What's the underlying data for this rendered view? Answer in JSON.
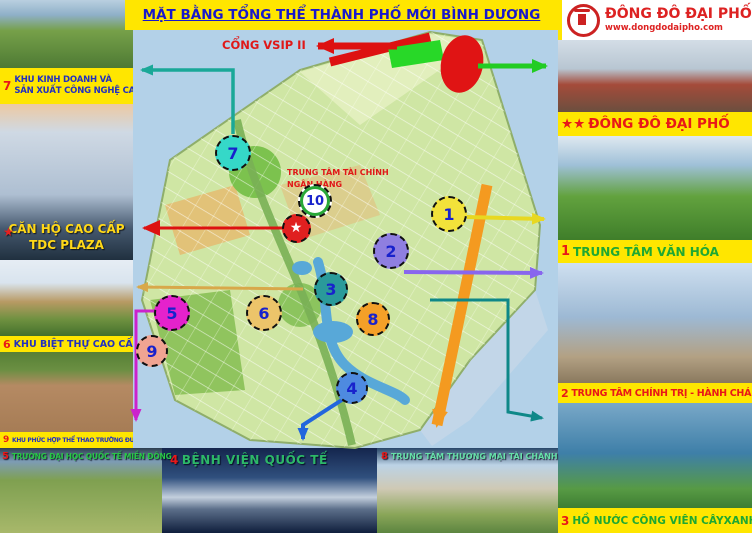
{
  "header": {
    "title": "MẶT BẰNG TỔNG THỂ THÀNH PHỐ MỚI BÌNH DƯƠNG"
  },
  "logo": {
    "name": "ĐÔNG ĐÔ ĐẠI PHỐ",
    "website": "www.dongdodaipho.com"
  },
  "colors": {
    "accent_yellow": "#ffe600",
    "accent_red": "#dd2222",
    "accent_blue": "#1818cc",
    "map_water": "#b3d1e8"
  },
  "left_column": {
    "label_7": {
      "num": "7",
      "line1": "KHU KINH DOANH VÀ",
      "line2": "SẢN XUẤT CÔNG NGHỆ CAO"
    },
    "tdc_overlay": {
      "star": "★",
      "line1": "CĂN HỘ CAO CẤP",
      "line2": "TDC PLAZA"
    },
    "label_6": {
      "num": "6",
      "text": "KHU BIỆT THỰ CAO CẤP"
    },
    "label_9": {
      "num": "9",
      "text": "KHU PHỨC HỢP THỂ THAO TRƯỜNG ĐUA NGỰA"
    }
  },
  "bottom_row": {
    "label_5": {
      "num": "5",
      "text": "TRƯỜNG ĐẠI HỌC QUỐC TẾ MIỀN ĐÔNG"
    },
    "label_4": {
      "num": "4",
      "text": "BỆNH VIỆN QUỐC TẾ"
    },
    "label_8": {
      "num": "8",
      "text": "TRUNG TÂM THƯƠNG MẠI TÀI CHÁNH"
    }
  },
  "right_column": {
    "label_brand": {
      "stars": "★★",
      "text": "ĐÔNG ĐÔ ĐẠI PHỐ"
    },
    "label_1": {
      "num": "1",
      "text": "TRUNG TÂM VĂN HÓA"
    },
    "label_2": {
      "num": "2",
      "text": "TRUNG TÂM CHÍNH TRỊ - HÀNH CHÁNH"
    },
    "label_3": {
      "num": "3",
      "text": "HỒ NƯỚC CÔNG VIÊN CÂYXANH"
    }
  },
  "map": {
    "gate_label": "CỔNG VSIP II",
    "finance_label_line1": "TRUNG TÂM TÀI CHÍNH",
    "finance_label_line2": "NGÂN HÀNG",
    "markers": [
      {
        "name": "7",
        "label": "7",
        "x": 233,
        "y": 153,
        "size": 36,
        "color": "#35d8c8"
      },
      {
        "name": "10",
        "label": "10",
        "x": 315,
        "y": 201,
        "size": 34,
        "color": "#ffffff",
        "ring": "#28a838",
        "font": 13
      },
      {
        "name": "star",
        "label": "★",
        "x": 296,
        "y": 228,
        "size": 29,
        "color": "#e02020",
        "text_color": "#ffffff",
        "font": 14
      },
      {
        "name": "1",
        "label": "1",
        "x": 449,
        "y": 214,
        "size": 36,
        "color": "#f2e23a"
      },
      {
        "name": "2",
        "label": "2",
        "x": 391,
        "y": 251,
        "size": 36,
        "color": "#8f7fe0"
      },
      {
        "name": "3",
        "label": "3",
        "x": 331,
        "y": 289,
        "size": 34,
        "color": "#2a9a9a"
      },
      {
        "name": "5",
        "label": "5",
        "x": 172,
        "y": 313,
        "size": 36,
        "color": "#e422cc"
      },
      {
        "name": "6",
        "label": "6",
        "x": 264,
        "y": 313,
        "size": 36,
        "color": "#ecc46a"
      },
      {
        "name": "8",
        "label": "8",
        "x": 373,
        "y": 319,
        "size": 34,
        "color": "#f4a028"
      },
      {
        "name": "9",
        "label": "9",
        "x": 152,
        "y": 351,
        "size": 32,
        "color": "#f0a492"
      },
      {
        "name": "4",
        "label": "4",
        "x": 352,
        "y": 388,
        "size": 32,
        "color": "#4e8ae0"
      }
    ]
  }
}
